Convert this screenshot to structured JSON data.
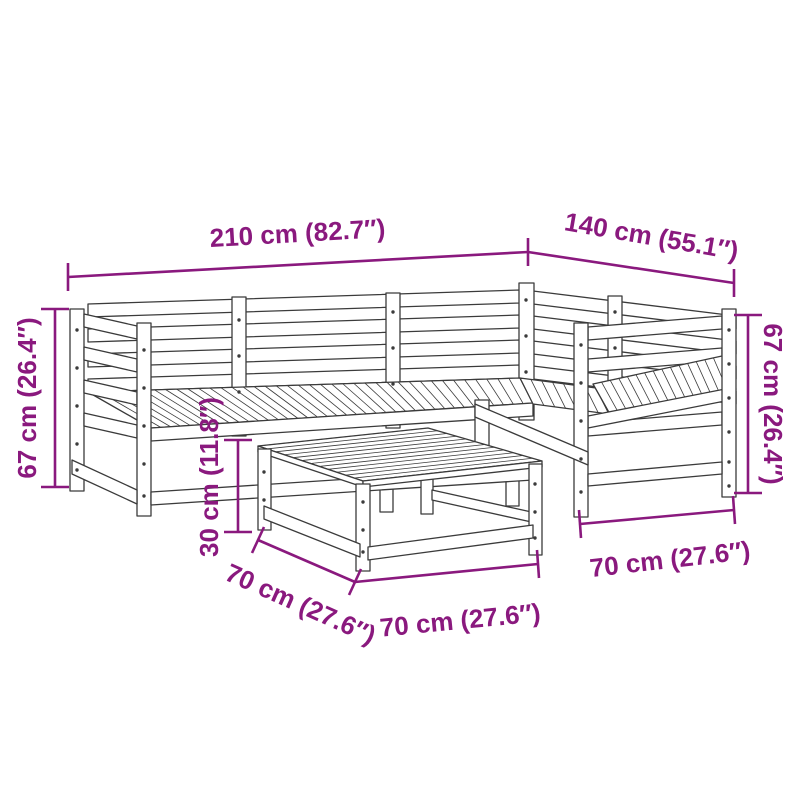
{
  "diagram": {
    "type": "product-dimension-diagram",
    "subject": "5-piece wooden garden corner sofa set with coffee table, isometric line drawing",
    "style": {
      "accent_color": "#8A197E",
      "drawing_line_color": "#3B3B3B",
      "background_color": "#FFFFFF"
    },
    "labels": {
      "overall_width": "210 cm (82.7″)",
      "overall_depth": "140 cm (55.1″)",
      "height_left": "67 cm (26.4″)",
      "height_right": "67 cm (26.4″)",
      "table_height": "30 cm (11.8″)",
      "footprint_left": "70 cm (27.6″)",
      "footprint_front": "70 cm (27.6″)",
      "footprint_right": "70 cm (27.6″)"
    }
  }
}
